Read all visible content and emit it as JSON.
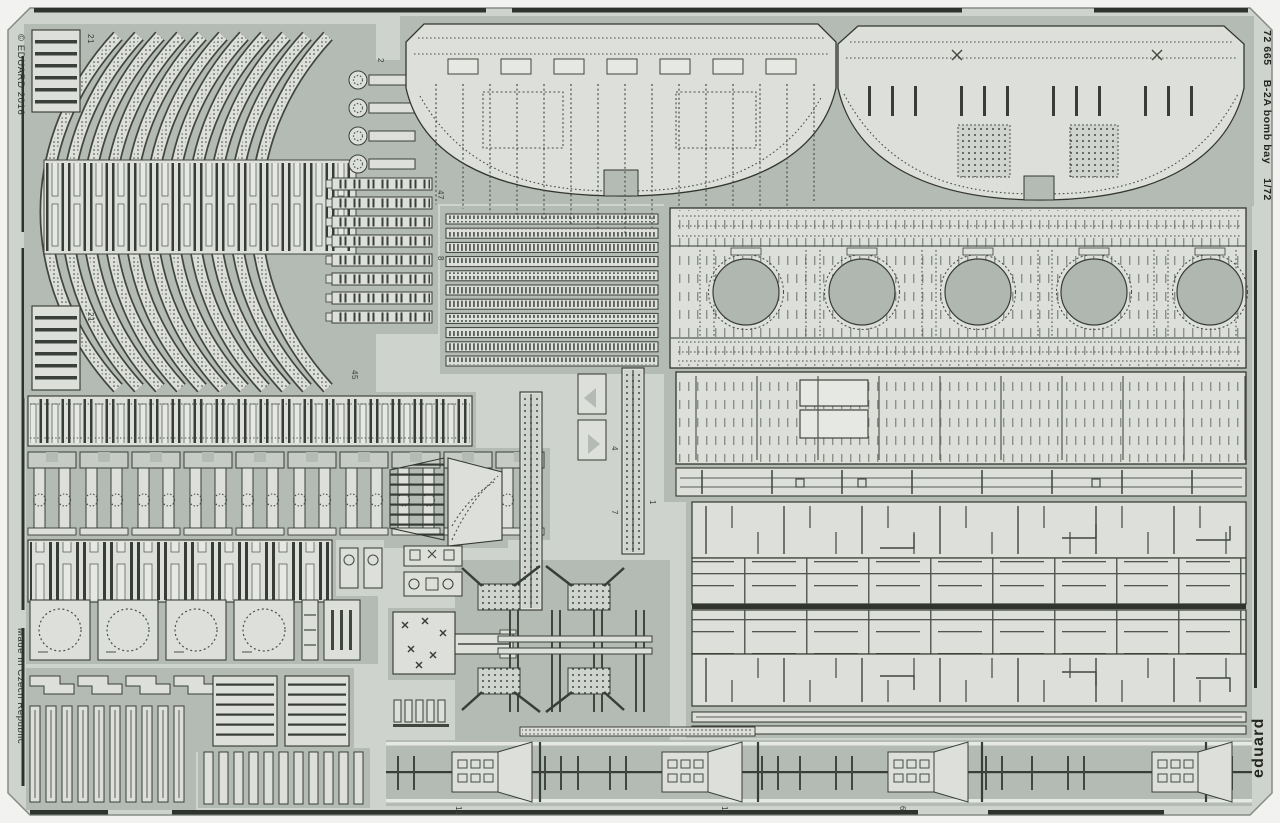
{
  "product": {
    "code": "72 665",
    "title": "B-2A bomb bay",
    "scale": "1/72",
    "brand": "eduard",
    "copyright": "© EDUARD 2016",
    "made_in": "Made in Czech Republic"
  },
  "part_numbers": {
    "p21a": "21",
    "p21b": "21",
    "p2": "2",
    "p47": "47",
    "p8": "8",
    "p45": "45",
    "p4": "4",
    "p7": "7",
    "p1": "1",
    "p11a": "11",
    "p11b": "11",
    "p6": "6"
  },
  "colors": {
    "background": "#f2f3f0",
    "sheet": "#ced3cd",
    "etched_web": "#b4bab4",
    "part_surface": "#dde0da",
    "etch_line": "#32372f"
  }
}
